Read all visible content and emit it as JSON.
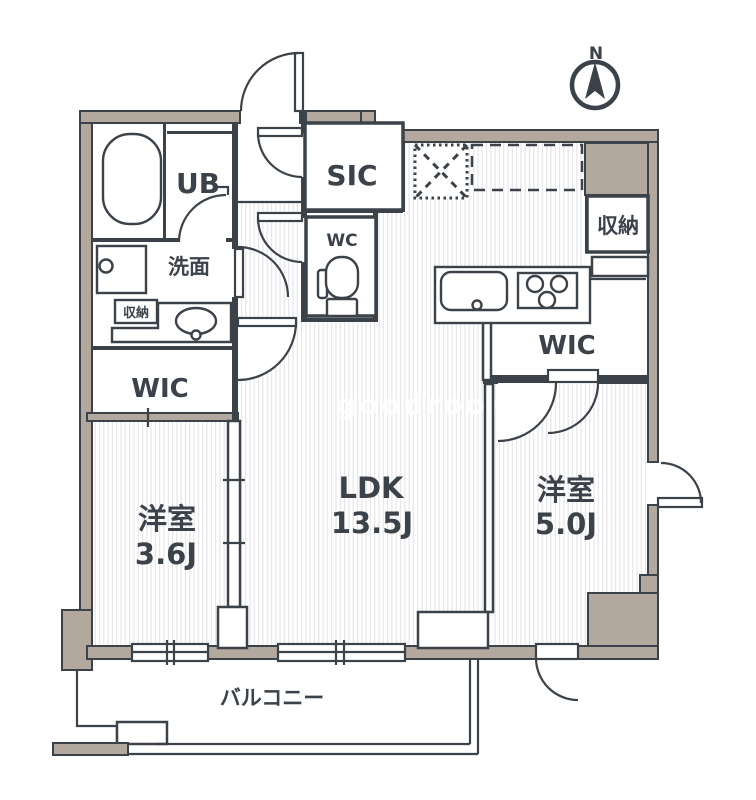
{
  "colors": {
    "wall": "#b3a89e",
    "line": "#3b4249",
    "bg": "#ffffff"
  },
  "compass": {
    "label": "N"
  },
  "watermark": {
    "text": "goodroom"
  },
  "labels": {
    "unit_bath": "UB",
    "washroom": "洗面",
    "storage_small": "収納",
    "wic_left": "WIC",
    "bedroom_left_name": "洋室",
    "bedroom_left_size": "3.6J",
    "shoe_closet": "SIC",
    "toilet": "WC",
    "ldk_name": "LDK",
    "ldk_size": "13.5J",
    "storage_right": "収納",
    "wic_right": "WIC",
    "bedroom_right_name": "洋室",
    "bedroom_right_size": "5.0J",
    "balcony": "バルコニー"
  }
}
